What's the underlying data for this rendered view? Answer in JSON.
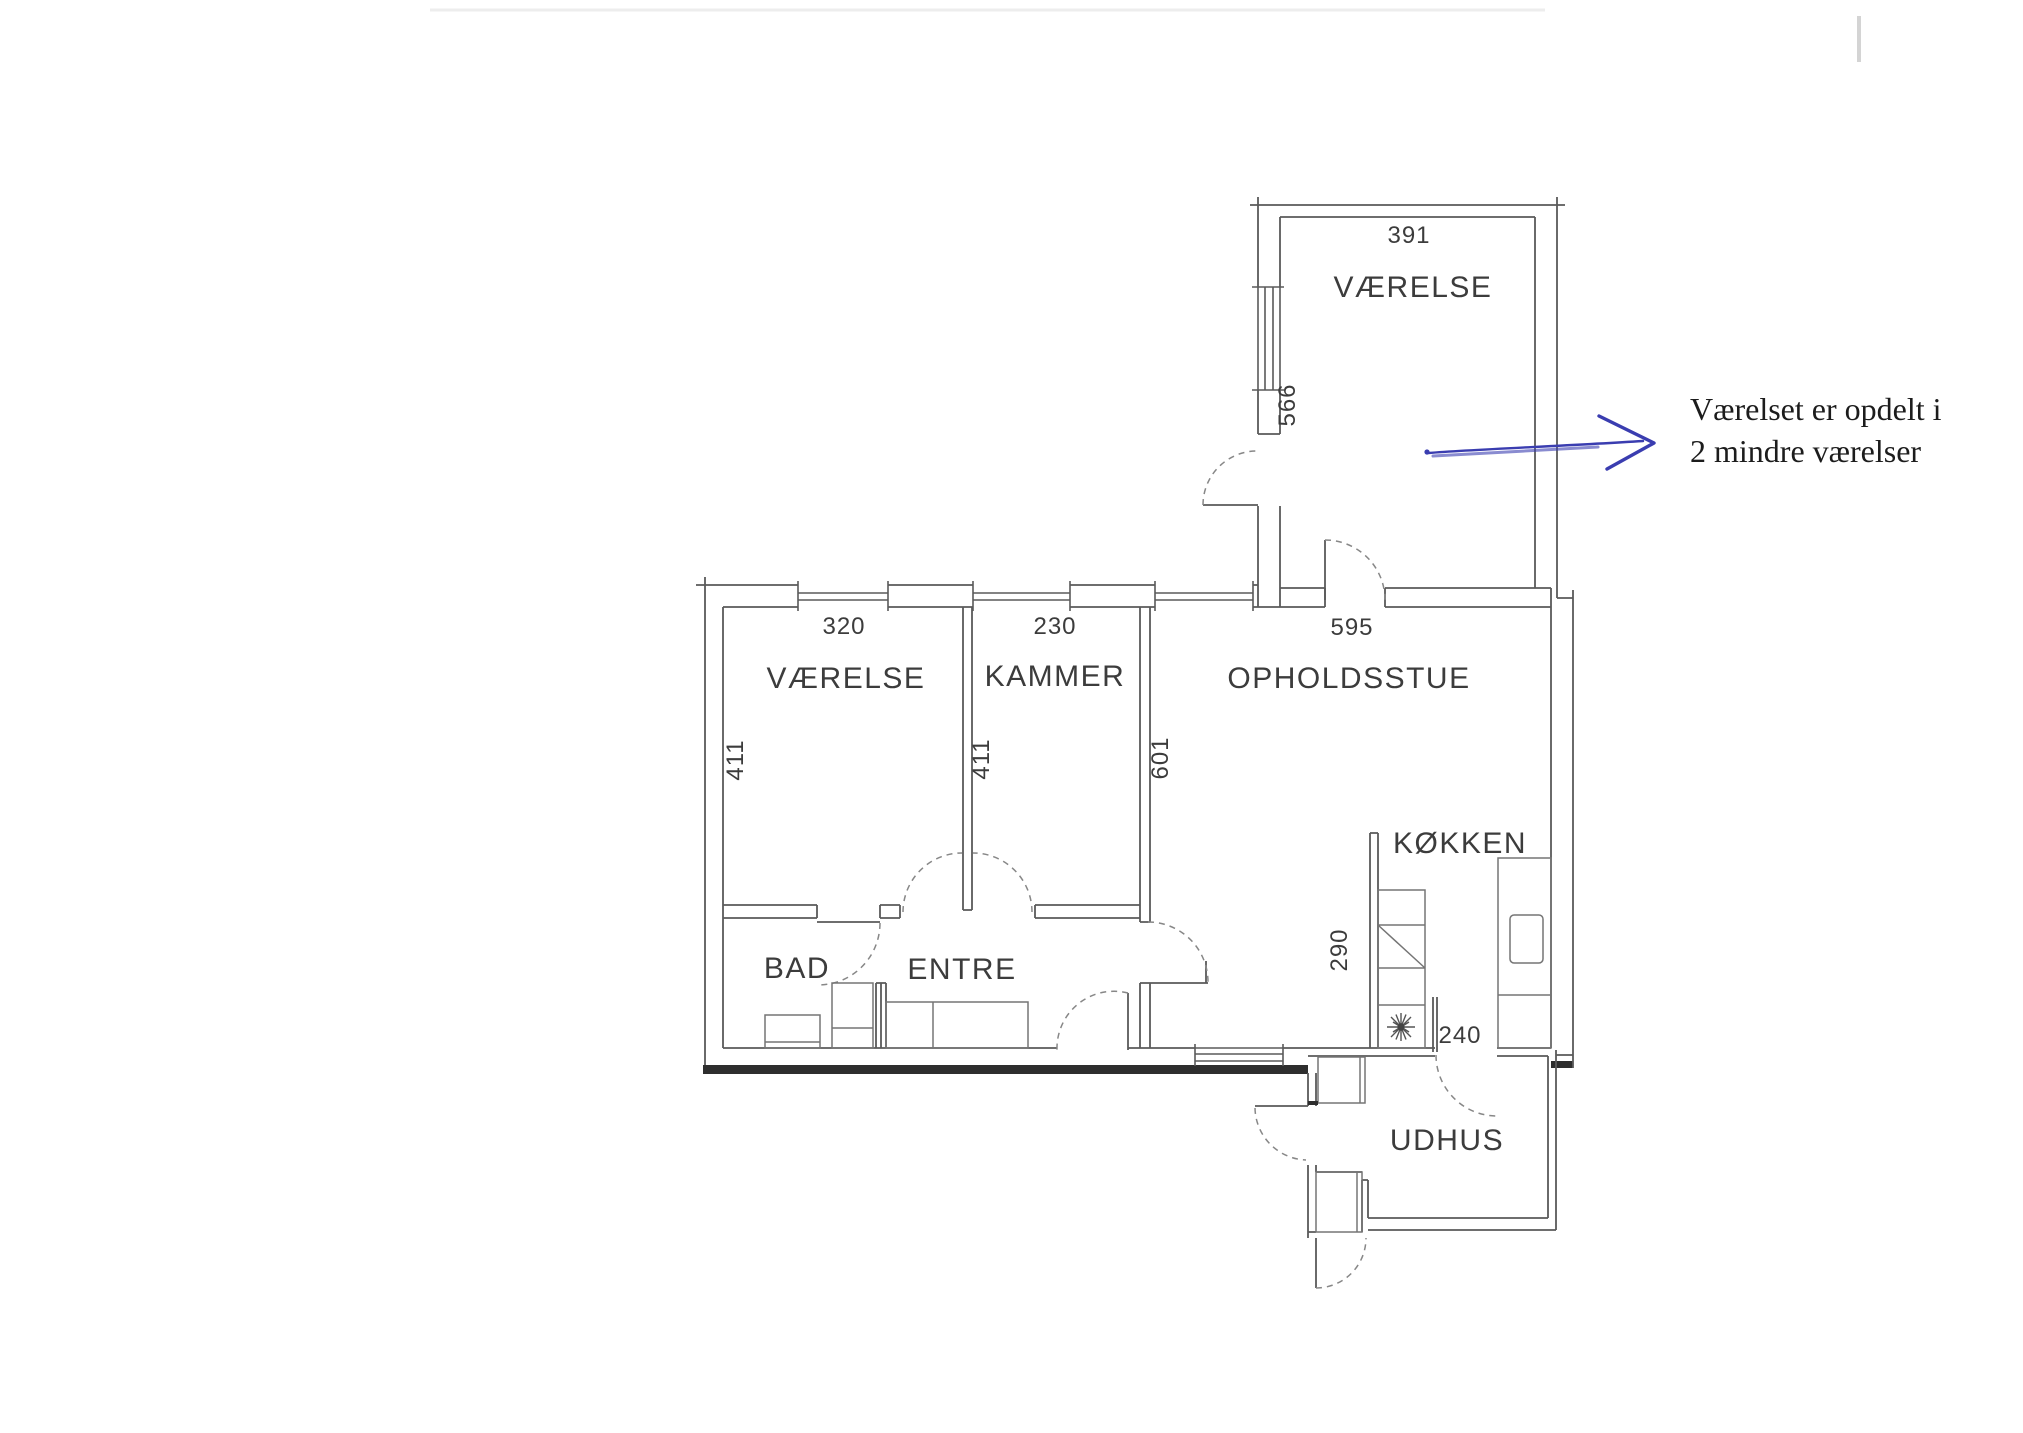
{
  "page": {
    "background": "#ffffff",
    "kind": "scanned floor plan"
  },
  "colors": {
    "wall": "#5a5a5a",
    "wall_dark": "#2e2e2e",
    "fixture": "#757575",
    "door_arc": "#878787",
    "label_text": "#3c3c3c",
    "pen_blue": "#3a3db0",
    "annotation_text": "#1c1c1c"
  },
  "plan": {
    "rooms": [
      {
        "id": "vaerelse-top",
        "label": "VÆRELSE",
        "width": "391",
        "depth": "566"
      },
      {
        "id": "vaerelse",
        "label": "VÆRELSE",
        "width": "320",
        "depth": "411"
      },
      {
        "id": "kammer",
        "label": "KAMMER",
        "width": "230",
        "depth": "411"
      },
      {
        "id": "opholdsstue",
        "label": "OPHOLDSSTUE",
        "width": "595",
        "depth": "601"
      },
      {
        "id": "koekken",
        "label": "KØKKEN",
        "width": "240",
        "depth": "290"
      },
      {
        "id": "bad",
        "label": "BAD"
      },
      {
        "id": "entre",
        "label": "ENTRE"
      },
      {
        "id": "udhus",
        "label": "UDHUS"
      }
    ]
  },
  "annotation": {
    "line1": "Værelset er opdelt i",
    "line2": "2 mindre værelser"
  }
}
